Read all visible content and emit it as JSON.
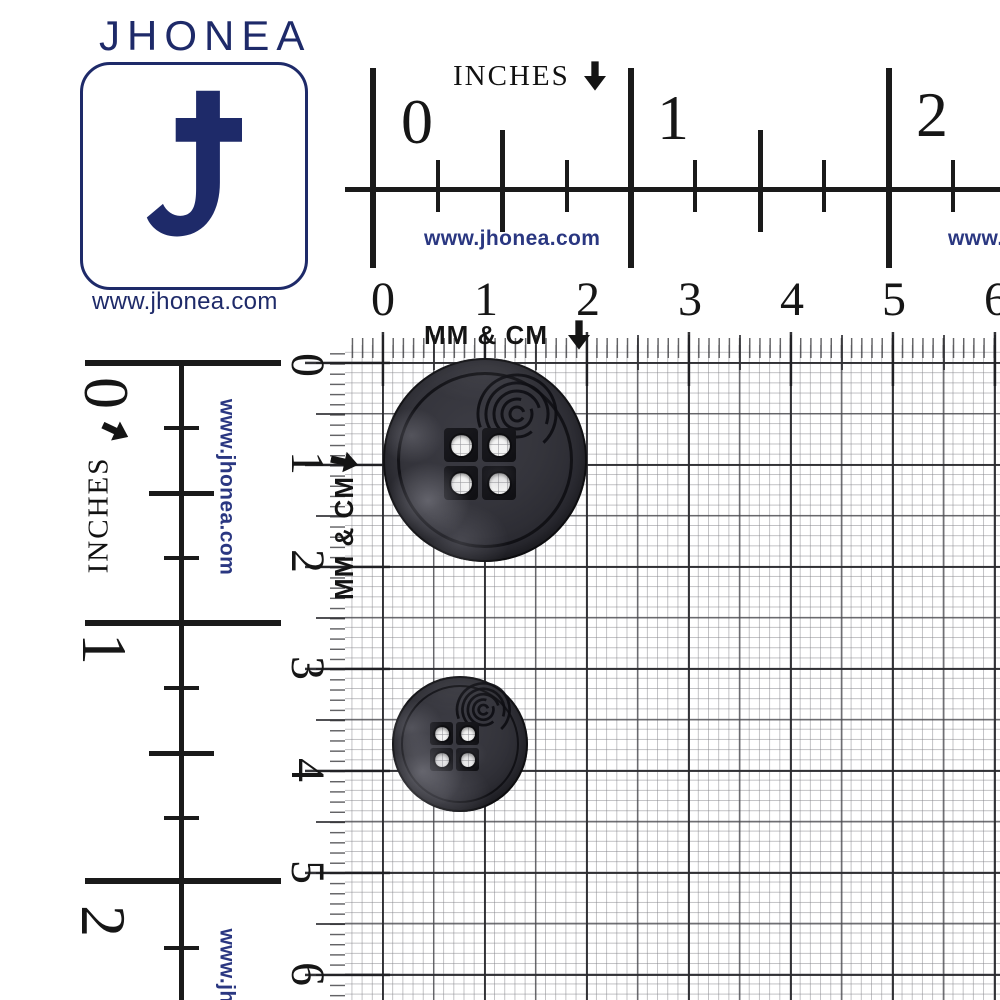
{
  "brand": {
    "name": "JHONEA",
    "website": "www.jhonea.com"
  },
  "logo": {
    "wordmark": "JHONEA",
    "monogram": "J",
    "url_caption": "www.jhonea.com"
  },
  "rulers": {
    "top_inches": {
      "label": "INCHES",
      "arrow": "down",
      "numbers": [
        "0",
        "1",
        "2"
      ],
      "watermark": "www.jhonea.com",
      "watermark_right_clipped": "www.j"
    },
    "top_cm": {
      "label": "MM & CM",
      "arrow": "down",
      "numbers": [
        "0",
        "1",
        "2",
        "3",
        "4",
        "5",
        "6"
      ]
    },
    "left_inches": {
      "label": "INCHES",
      "arrow": "down",
      "numbers": [
        "0",
        "1",
        "2"
      ],
      "watermark": "www.jhonea.com",
      "watermark_bottom_clipped": "www.jh"
    },
    "left_cm": {
      "label": "MM & CM",
      "arrow": "down",
      "numbers": [
        "0",
        "1",
        "2",
        "3",
        "4",
        "5",
        "6"
      ]
    }
  },
  "products": {
    "large_button": {
      "name": "4-hole round black button (large)",
      "holes": 4,
      "size_on_scale": "approx. 20 mm — spans 0 to 2 cm on grid"
    },
    "small_button": {
      "name": "4-hole round black button (small)",
      "holes": 4,
      "size_on_scale": "approx. 13 mm — spans 3 to 4.3 cm on grid"
    }
  },
  "colors": {
    "navy": "#1e2a69",
    "watermark_navy": "#2a3781",
    "ink": "#1a1a1a",
    "grid_light": "#82828a",
    "grid_dark": "#46464a",
    "button_body": "#2f2f36",
    "hole_white": "#f4f4f4"
  }
}
